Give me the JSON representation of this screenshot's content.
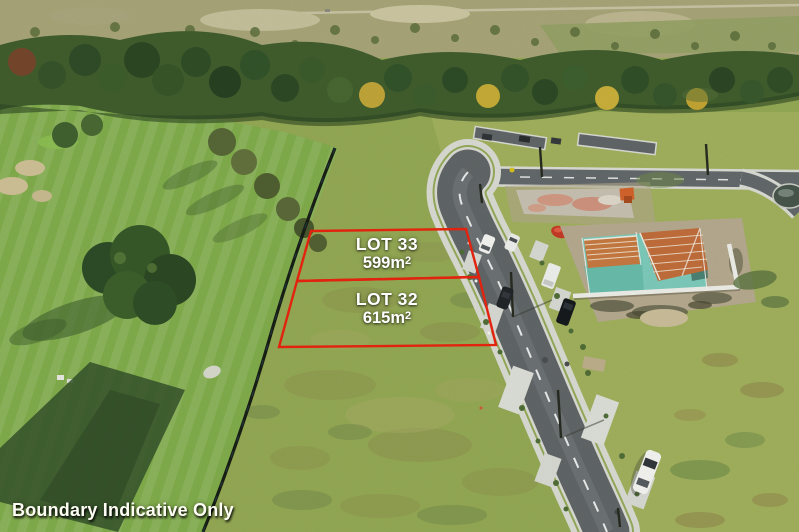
{
  "lots": [
    {
      "name": "LOT 33",
      "area_base": "599m",
      "area_exponent": "2"
    },
    {
      "name": "LOT 32",
      "area_base": "615m",
      "area_exponent": "2"
    }
  ],
  "footer": {
    "disclaimer": "Boundary Indicative Only"
  },
  "colors": {
    "boundary_red": "#e8220e",
    "label_white": "#ffffff"
  }
}
